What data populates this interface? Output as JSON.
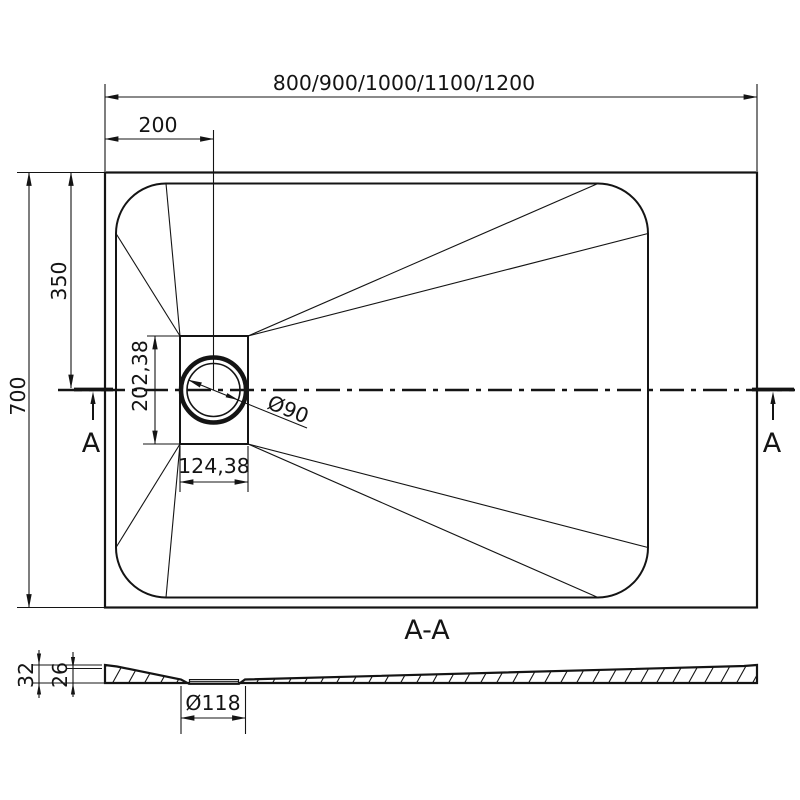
{
  "plan_view": {
    "width_dim": "800/900/1000/1100/1200",
    "drain_offset_dim": "200",
    "height_dim": "700",
    "center_dim": "350",
    "drain_height_dim": "202,38",
    "drain_width_dim": "124,38",
    "drain_diameter_dim": "Ø90",
    "section_label_left": "A",
    "section_label_right": "A"
  },
  "section_view": {
    "title": "A-A",
    "total_height_dim": "32",
    "basin_depth_dim": "26",
    "drain_diameter_dim": "Ø118"
  },
  "colors": {
    "line": "#141414",
    "background": "#ffffff"
  }
}
